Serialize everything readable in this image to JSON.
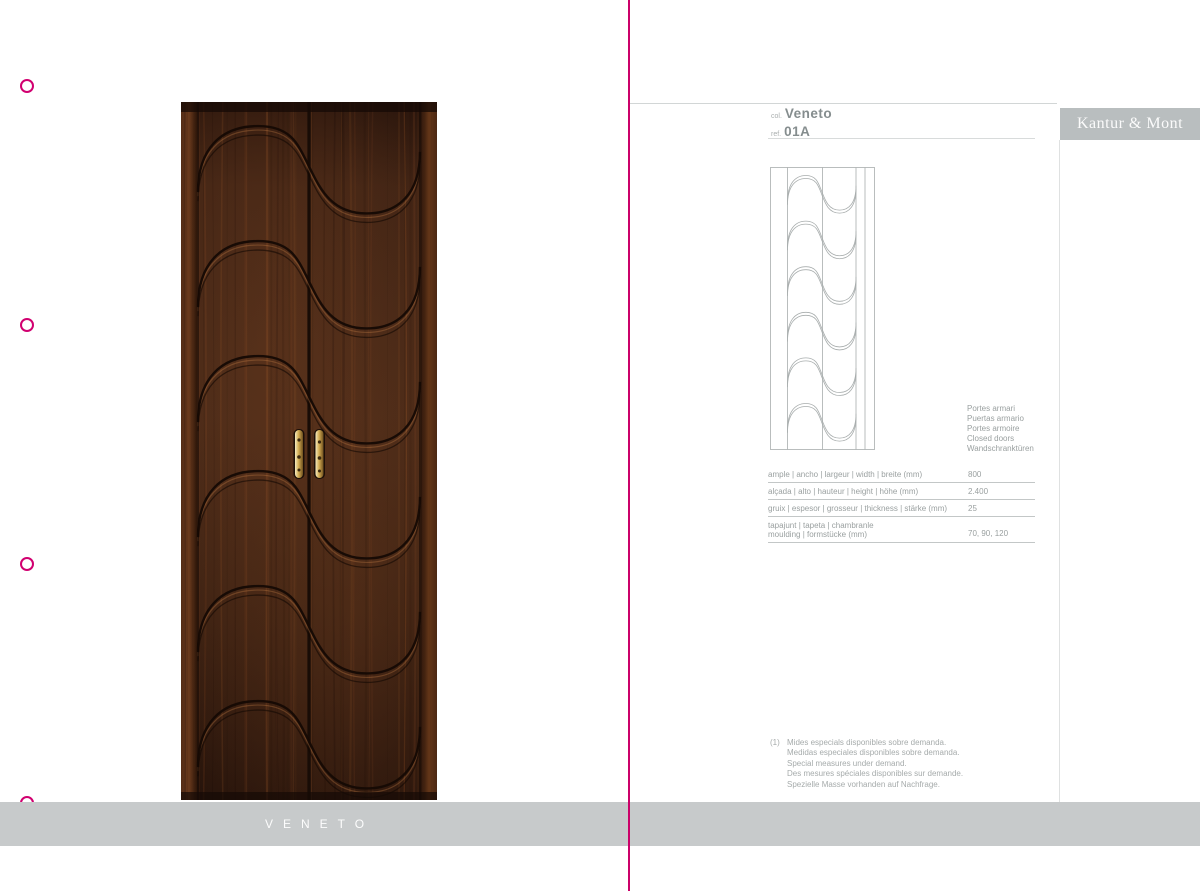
{
  "accent_color": "#d10070",
  "left_page": {
    "collection_banner_label": "VENETO"
  },
  "right_page": {
    "header": {
      "col_label": "col.",
      "collection_name": "Veneto",
      "ref_label": "ref.",
      "ref_value": "01A"
    },
    "brand_banner": "Kantur & Mont",
    "caption_lines": [
      "Portes armari",
      "Puertas armario",
      "Portes armoire",
      "Closed doors",
      "Wandschranktüren"
    ],
    "spec_table": {
      "rows": [
        {
          "label": "ample | ancho | largeur | width | breite (mm)",
          "value": "800"
        },
        {
          "label": "alçada | alto | hauteur | height | höhe (mm)",
          "value": "2.400"
        },
        {
          "label": "gruix | espesor | grosseur | thickness | stärke (mm)",
          "value": "25"
        },
        {
          "label": "tapajunt | tapeta | chambranle",
          "label2": "moulding | formstücke (mm)",
          "value": "70, 90, 120"
        }
      ]
    },
    "footnote": {
      "marker": "(1)",
      "lines": [
        "Mides especials disponibles sobre demanda.",
        "Medidas especiales disponibles sobre demanda.",
        "Special measures under demand.",
        "Des mesures spéciales disponibles sur demande.",
        "Spezielle Masse vorhanden auf Nachfrage."
      ]
    }
  }
}
